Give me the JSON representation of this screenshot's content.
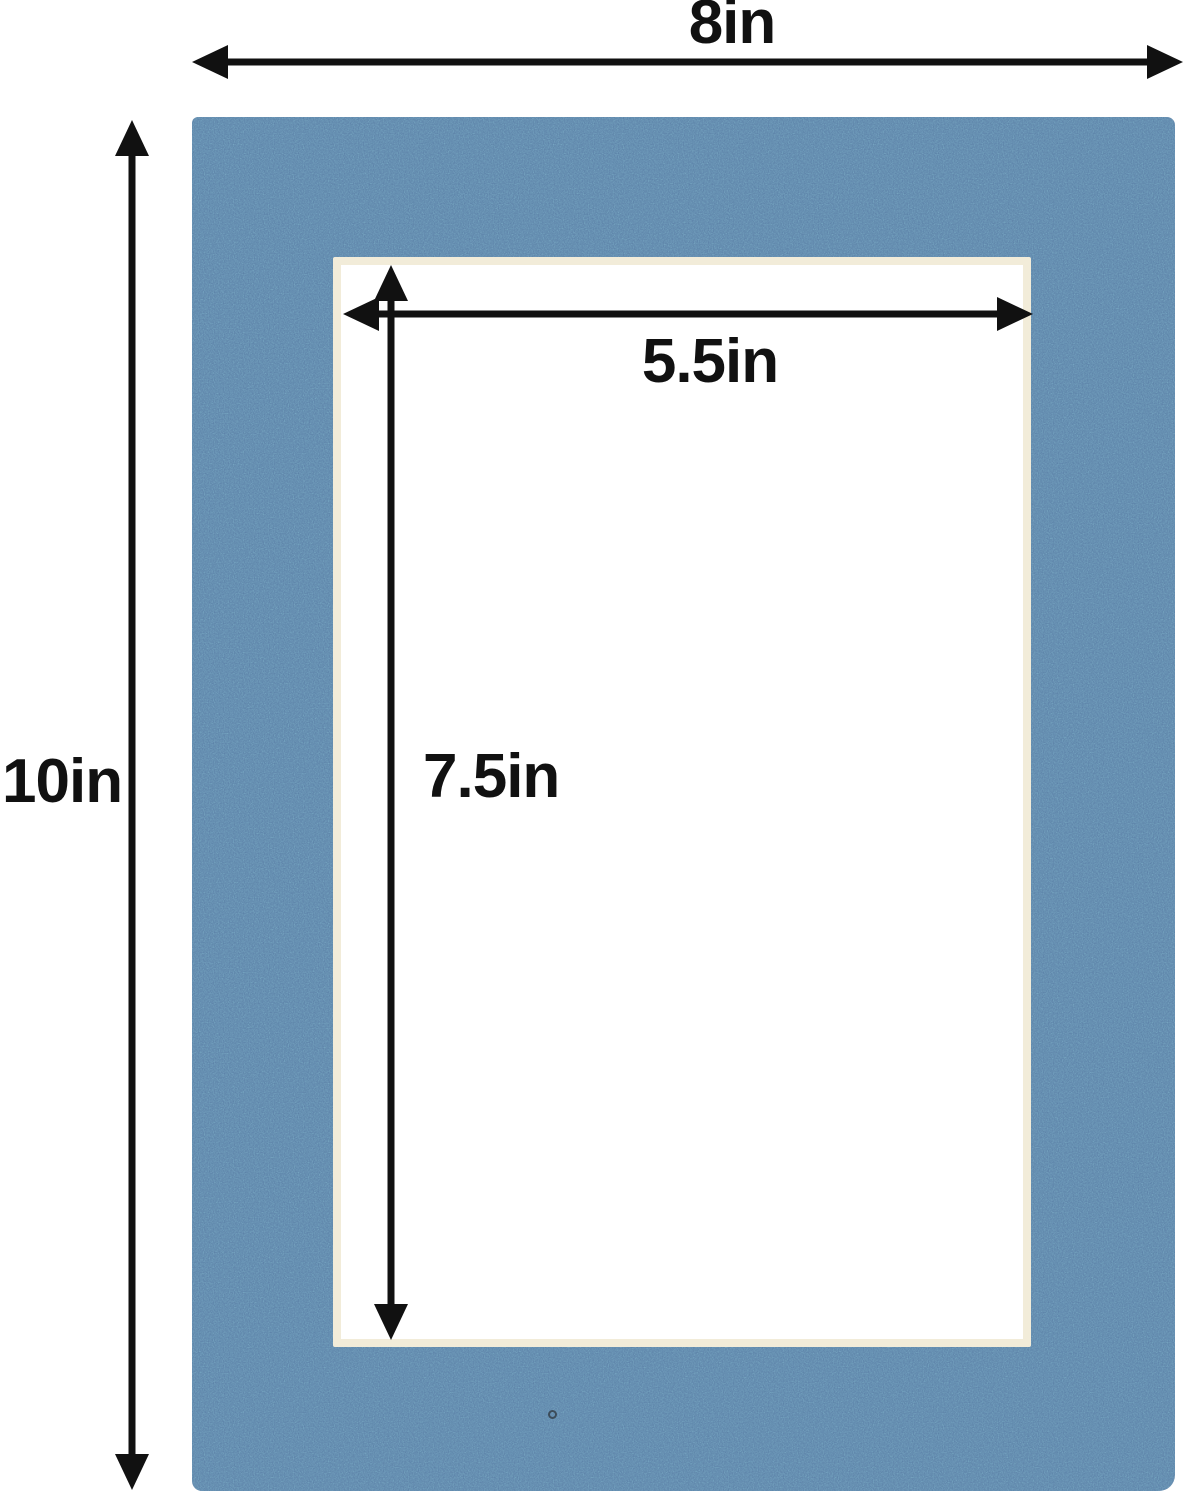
{
  "dimensions": {
    "outer_width": {
      "label": "8in",
      "value": 8,
      "unit": "in"
    },
    "outer_height": {
      "label": "10in",
      "value": 10,
      "unit": "in"
    },
    "opening_width": {
      "label": "5.5in",
      "value": 5.5,
      "unit": "in"
    },
    "opening_height": {
      "label": "7.5in",
      "value": 7.5,
      "unit": "in"
    }
  },
  "colors": {
    "mat_blue": "#5b80a7",
    "bevel_cream": "#f2ecd9",
    "opening_white": "#ffffff",
    "arrow_black": "#111111",
    "background_white": "#ffffff",
    "speck_dark": "#3c4c5a"
  }
}
